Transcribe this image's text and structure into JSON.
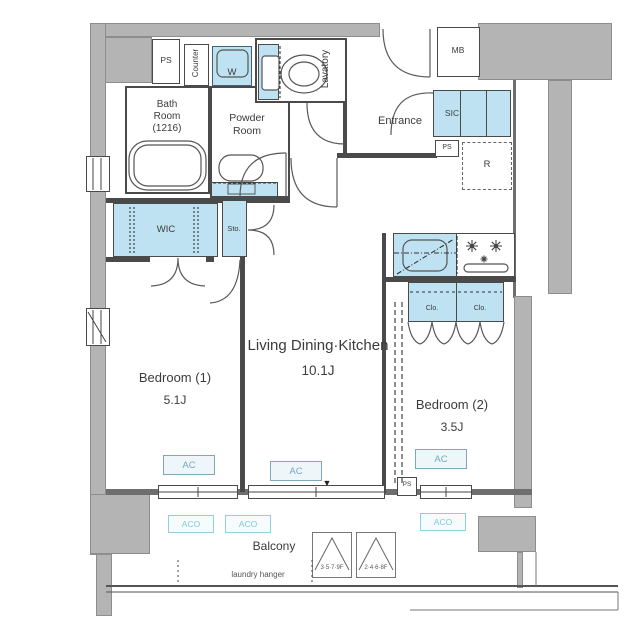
{
  "plan": {
    "rooms": {
      "bath_l1": "Bath",
      "bath_l2": "Room",
      "bath_l3": "(1216)",
      "powder_l1": "Powder",
      "powder_l2": "Room",
      "lavatory": "Lavatory",
      "entrance": "Entrance",
      "ldk_name": "Living Dining·Kitchen",
      "ldk_size": "10.1J",
      "bedroom1_name": "Bedroom (1)",
      "bedroom1_size": "5.1J",
      "bedroom2_name": "Bedroom (2)",
      "bedroom2_size": "3.5J",
      "balcony": "Balcony"
    },
    "storage": {
      "wic": "WIC",
      "sic": "SIC",
      "sto": "Sto.",
      "clo": "Clo."
    },
    "service": {
      "ps_top": "PS",
      "ps_mid": "PS",
      "ps_bottom": "PS",
      "mb": "MB",
      "counter": "Counter",
      "washer": "W",
      "fridge": "R"
    },
    "equipment": {
      "ac": "AC",
      "aco": "ACO"
    },
    "annotations": {
      "laundry_hanger": "laundry hanger",
      "window_floors_a": "3·5·7·9F",
      "window_floors_b": "2·4·6·8F",
      "vent_mark": "▼"
    },
    "colors": {
      "wall_gray": "#b4b4b4",
      "storage_blue": "#bfe2f2",
      "line": "#4a4a4a",
      "ac_accent": "#74a9bd",
      "aco_accent": "#7cc9d9"
    }
  }
}
